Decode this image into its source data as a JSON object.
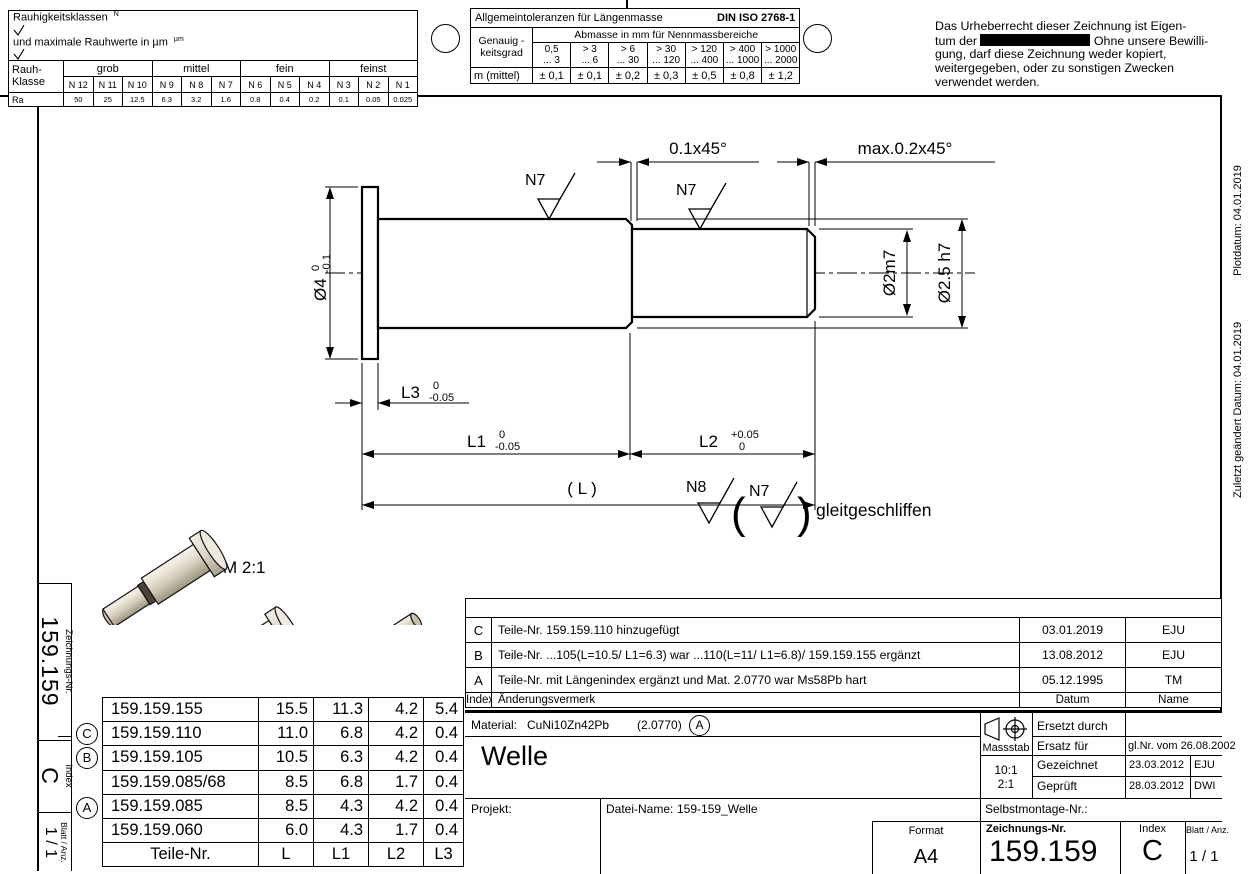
{
  "roughness_table": {
    "title_prefix": "Rauhigkeitsklassen",
    "symbol_n": "N",
    "title_mid": "und maximale Rauhwerte in µm",
    "symbol_um": "µm",
    "class_label_line1": "Rauh-",
    "class_label_line2": "Klasse",
    "groups": [
      "grob",
      "mittel",
      "fein",
      "feinst"
    ],
    "classes": [
      "N 12",
      "N 11",
      "N 10",
      "N 9",
      "N 8",
      "N 7",
      "N 6",
      "N 5",
      "N 4",
      "N 3",
      "N 2",
      "N 1"
    ],
    "ra_label": "Ra",
    "ra_values": [
      "50",
      "25",
      "12.5",
      "6.3",
      "3.2",
      "1.6",
      "0.8",
      "0.4",
      "0.2",
      "0.1",
      "0.05",
      "0.025"
    ]
  },
  "tolerance_table": {
    "title": "Allgemeintoleranzen für Längenmasse",
    "norm": "DIN ISO 2768-1",
    "row_header_line1": "Genauig -",
    "row_header_line2": "keitsgrad",
    "col_header": "Abmasse in mm für Nennmassbereiche",
    "ranges_top": [
      "0,5",
      "> 3",
      "> 6",
      "> 30",
      "> 120",
      "> 400",
      "> 1000"
    ],
    "ranges_bottom": [
      "... 3",
      "... 6",
      "... 30",
      "... 120",
      "... 400",
      "... 1000",
      "... 2000"
    ],
    "grade_label": "m (mittel)",
    "values": [
      "± 0,1",
      "± 0,1",
      "± 0,2",
      "± 0,3",
      "± 0,5",
      "± 0,8",
      "± 1,2"
    ]
  },
  "copyright": {
    "line1": "Das Urheberrecht dieser Zeichnung ist Eigen-",
    "line2_pre": "tum der",
    "line2_post": "Ohne unsere Bewilli-",
    "line3": "gung, darf diese Zeichnung weder kopiert,",
    "line4": "weitergegeben, oder zu sonstigen Zwecken",
    "line5": "verwendet werden."
  },
  "margin_notes": {
    "plotdatum": "Plotdatum: 04.01.2019",
    "geaendert": "Zuletzt geändert Datum: 04.01.2019"
  },
  "drawing": {
    "scale_note": "M 2:1",
    "dim_chamfer_step": "0.1x45°",
    "dim_chamfer_end": "max.0.2x45°",
    "surface_n7": "N7",
    "surface_n8": "N8",
    "paren_open": "(",
    "paren_close": ")",
    "finish_note": "gleitgeschliffen",
    "dia_flange_label": "Ø4",
    "dia_flange_tol_upper": "0",
    "dia_flange_tol_lower": "-0.1",
    "dia_mid": "Ø2.5 h7",
    "dia_end": "Ø2m7",
    "len_l1_label": "L1",
    "len_l1_tol_upper": "0",
    "len_l1_tol_lower": "-0.05",
    "len_l2_label": "L2",
    "len_l2_tol_upper": "+0.05",
    "len_l2_tol_lower": "0",
    "len_l3_label": "L3",
    "len_l3_tol_upper": "0",
    "len_l3_tol_lower": "-0.05",
    "len_total": "( L )"
  },
  "margin_strip": {
    "zeichnungsnr_label": "Zeichnungs-Nr.",
    "zeichnungsnr": "159.159",
    "index_label": "Index",
    "index": "C",
    "blatt_label": "Blatt / Anz.",
    "blatt": "1 / 1"
  },
  "parts_table": {
    "headers": {
      "nr": "Teile-Nr.",
      "l": "L",
      "l1": "L1",
      "l2": "L2",
      "l3": "L3"
    },
    "rows": [
      {
        "marker": "",
        "nr": "159.159.155",
        "l": "15.5",
        "l1": "11.3",
        "l2": "4.2",
        "l3": "5.4"
      },
      {
        "marker": "C",
        "nr": "159.159.110",
        "l": "11.0",
        "l1": "6.8",
        "l2": "4.2",
        "l3": "0.4"
      },
      {
        "marker": "B",
        "nr": "159.159.105",
        "l": "10.5",
        "l1": "6.3",
        "l2": "4.2",
        "l3": "0.4"
      },
      {
        "marker": "",
        "nr": "159.159.085/68",
        "l": "8.5",
        "l1": "6.8",
        "l2": "1.7",
        "l3": "0.4"
      },
      {
        "marker": "A",
        "nr": "159.159.085",
        "l": "8.5",
        "l1": "4.3",
        "l2": "4.2",
        "l3": "0.4"
      },
      {
        "marker": "",
        "nr": "159.159.060",
        "l": "6.0",
        "l1": "4.3",
        "l2": "1.7",
        "l3": "0.4"
      }
    ]
  },
  "revision_table": {
    "header": {
      "index": "Index",
      "note": "Änderungsvermerk",
      "date": "Datum",
      "name": "Name"
    },
    "rows": [
      {
        "index": "C",
        "note": "Teile-Nr. 159.159.110 hinzugefügt",
        "date": "03.01.2019",
        "name": "EJU"
      },
      {
        "index": "B",
        "note": "Teile-Nr. ...105(L=10.5/ L1=6.3) war ...110(L=11/ L1=6.8)/ 159.159.155 ergänzt",
        "date": "13.08.2012",
        "name": "EJU"
      },
      {
        "index": "A",
        "note": "Teile-Nr. mit Längenindex ergänzt und Mat. 2.0770 war Ms58Pb hart",
        "date": "05.12.1995",
        "name": "TM"
      }
    ]
  },
  "title_block": {
    "material_label": "Material:",
    "material": "CuNi10Zn42Pb",
    "material_no": "(2.0770)",
    "material_rev": "A",
    "part_title": "Welle",
    "massstab_label": "Massstab",
    "scale_1": "10:1",
    "scale_2": "2:1",
    "ersetzt_label": "Ersetzt durch",
    "ersetzt_value": "",
    "ersatz_label": "Ersatz für",
    "ersatz_value": "gl.Nr. vom 26.08.2002",
    "gezeichnet_label": "Gezeichnet",
    "gezeichnet_date": "23.03.2012",
    "gezeichnet_name": "EJU",
    "geprueft_label": "Geprüft",
    "geprueft_date": "28.03.2012",
    "geprueft_name": "DWI",
    "projekt_label": "Projekt:",
    "datei_label": "Datei-Name:",
    "datei_value": "159-159_Welle",
    "selbstmontage_label": "Selbstmontage-Nr.:",
    "format_label": "Format",
    "format_value": "A4",
    "zeichnungsnr_label": "Zeichnungs-Nr.",
    "zeichnungsnr_value": "159.159",
    "index_label": "Index",
    "index_value": "C",
    "blatt_label": "Blatt / Anz.",
    "blatt_value": "1 / 1"
  },
  "colors": {
    "ink": "#000000",
    "pin_body": "#e9e4d8",
    "pin_shadow": "#a89f8a",
    "pin_face": "#d9d0bb"
  }
}
